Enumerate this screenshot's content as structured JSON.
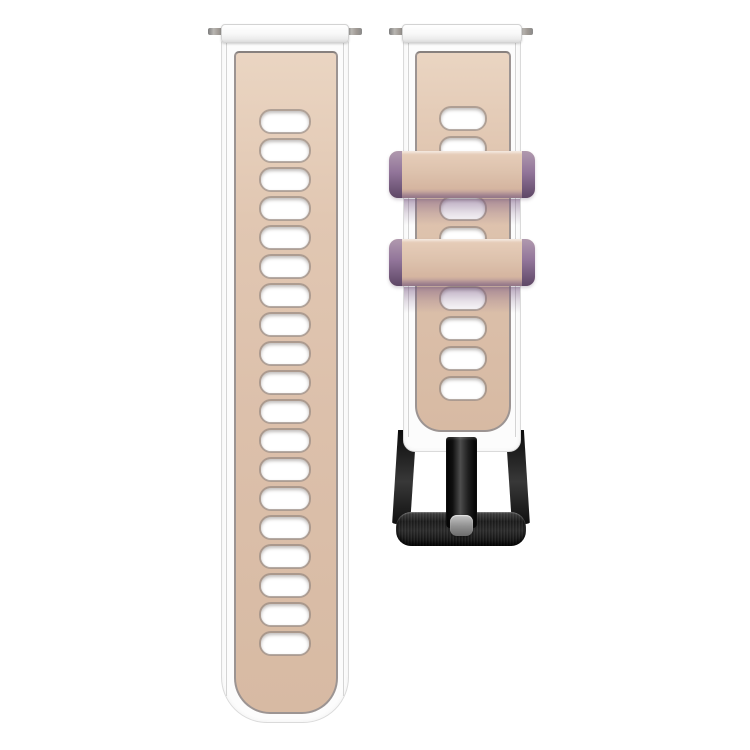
{
  "scene": {
    "alt_text": "Two-piece silicone watch band, beige pink with white edges, two lavender keeper loops and black buckle, on white background",
    "background": "#ffffff"
  },
  "colors": {
    "bg": "#ffffff",
    "band_white": "#fcfcfc",
    "band_edge_line": "#cfcfcf",
    "panel_beige": "#dcc0ab",
    "panel_beige_light": "#ead5c2",
    "panel_beige_dark": "#d7baa3",
    "panel_outline": "#9c9492",
    "slot_fill": "#ffffff",
    "slot_rim": "#847a77",
    "keeper_purple_light": "#b099ae",
    "keeper_purple_dark": "#5e4766",
    "buckle_black": "#1c1c1c",
    "prong_tip_gray": "#8f8f8f",
    "spring_bar_gray": "#9b9b9b"
  },
  "left_strap": {
    "slot_count": 19
  },
  "right_strap": {
    "slot_count": 10,
    "keeper_count": 2
  }
}
